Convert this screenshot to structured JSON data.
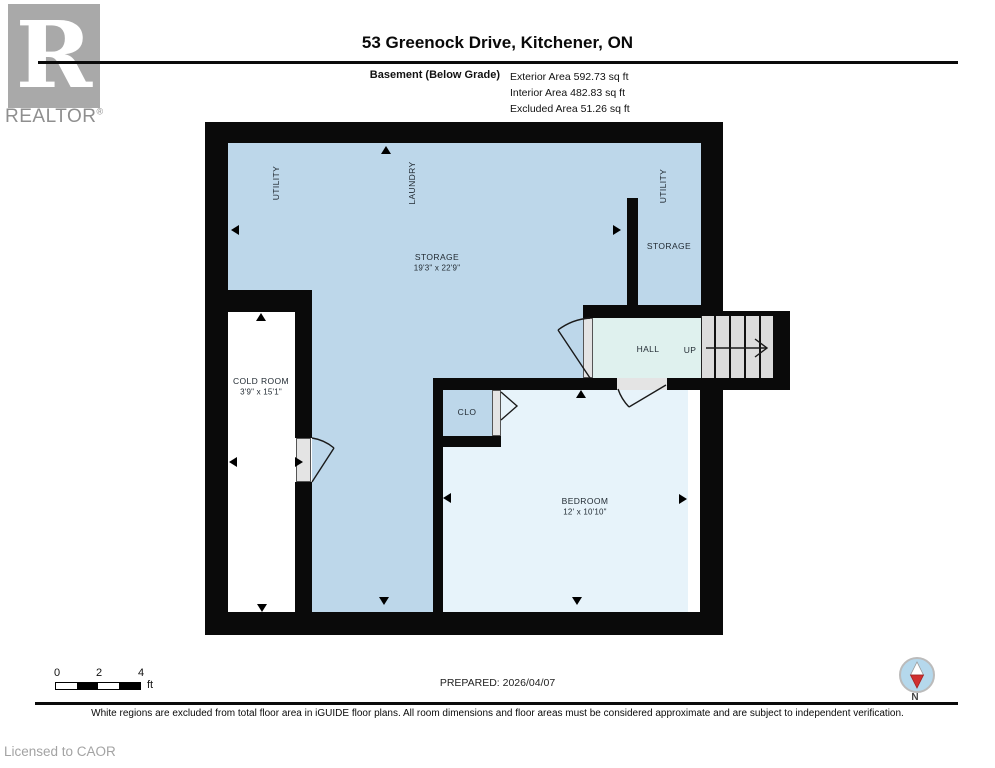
{
  "colors": {
    "wall": "#0a0a0a",
    "room-blue": "#bdd7ea",
    "room-lightblue": "#e7f3fa",
    "room-cyan": "#dff1ee",
    "stairs-gray": "#dcdcdc",
    "door-gray": "#e4e4e4",
    "label-ink": "#222b33",
    "logo-gray": "#a9a9a9",
    "brand-gray": "#8f8f8f",
    "muted-gray": "#a3a3a3",
    "compass-blue": "#b5d8ec",
    "compass-red": "#d03030"
  },
  "header": {
    "logo_letter": "R",
    "brand": "REALTOR",
    "registered": "®",
    "title": "53 Greenock Drive, Kitchener, ON",
    "floor_label": "Basement (Below Grade)",
    "area_lines": [
      "Exterior Area 592.73 sq ft",
      "Interior Area 482.83 sq ft",
      "Excluded Area 51.26 sq ft"
    ]
  },
  "plan": {
    "rooms": {
      "utility_left": "UTILITY",
      "laundry": "LAUNDRY",
      "utility_right": "UTILITY",
      "storage_main": {
        "name": "STORAGE",
        "dims": "19'3\" x 22'9\""
      },
      "storage_right": "STORAGE",
      "hall": "HALL",
      "up": "UP",
      "cold_room": {
        "name": "COLD ROOM",
        "dims": "3'9\" x 15'1\""
      },
      "closet": "CLO",
      "bedroom": {
        "name": "BEDROOM",
        "dims": "12' x 10'10\""
      }
    }
  },
  "footer": {
    "scale_ticks": [
      "0",
      "2",
      "4"
    ],
    "scale_unit": "ft",
    "prepared": "PREPARED: 2026/04/07",
    "compass_label": "N",
    "disclaimer": "White regions are excluded from total floor area in iGUIDE floor plans. All room dimensions and floor areas must be considered approximate and are subject to independent verification.",
    "license": "Licensed to CAOR"
  }
}
